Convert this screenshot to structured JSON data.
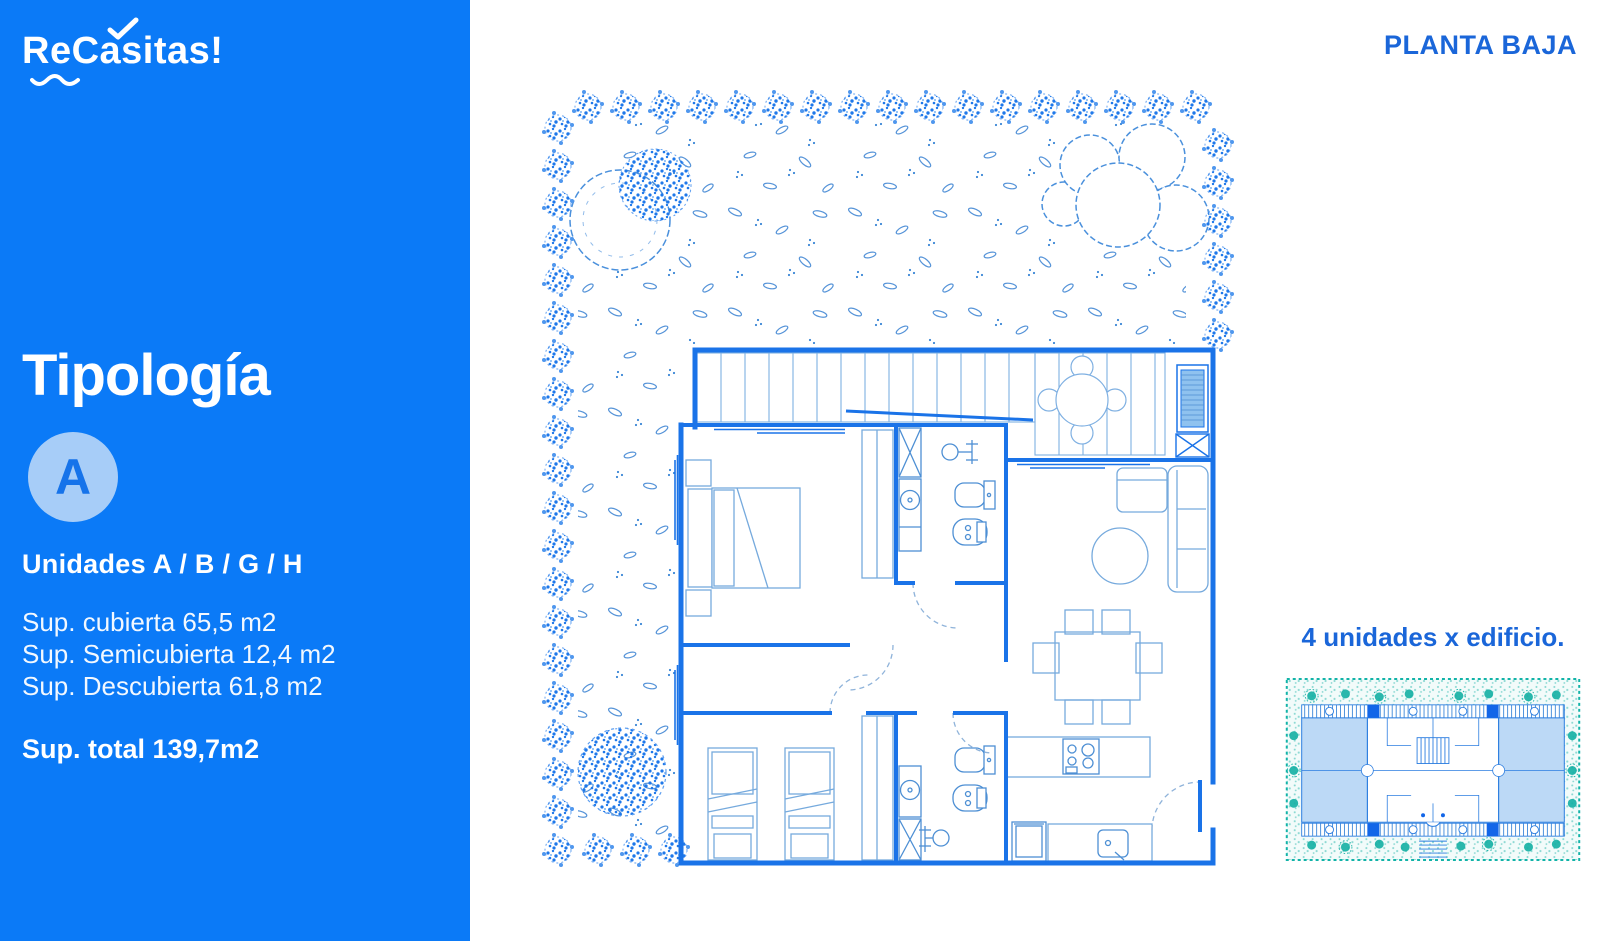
{
  "brand": {
    "name_prefix": "Re",
    "name_suffix": "Casitas!"
  },
  "header": {
    "plan_label": "PLANTA BAJA"
  },
  "typology": {
    "title": "Tipología",
    "badge_letter": "A",
    "units_line": "Unidades A / B / G / H",
    "surface_lines": [
      "Sup. cubierta 65,5 m2",
      "Sup. Semicubierta 12,4 m2",
      "Sup. Descubierta 61,8 m2"
    ],
    "total_line": "Sup. total 139,7m2"
  },
  "building_note": {
    "caption": "4 unidades x edificio."
  },
  "colors": {
    "sidebar_blue": "#0b7af7",
    "accent_blue": "#1a66d9",
    "wall_blue": "#1a73e8",
    "light_furniture_blue": "#76aadd",
    "badge_bg": "#a7cdf8",
    "badge_text": "#1673ea",
    "teal": "#14b0a4",
    "wing_highlight": "#bcd9f6"
  }
}
